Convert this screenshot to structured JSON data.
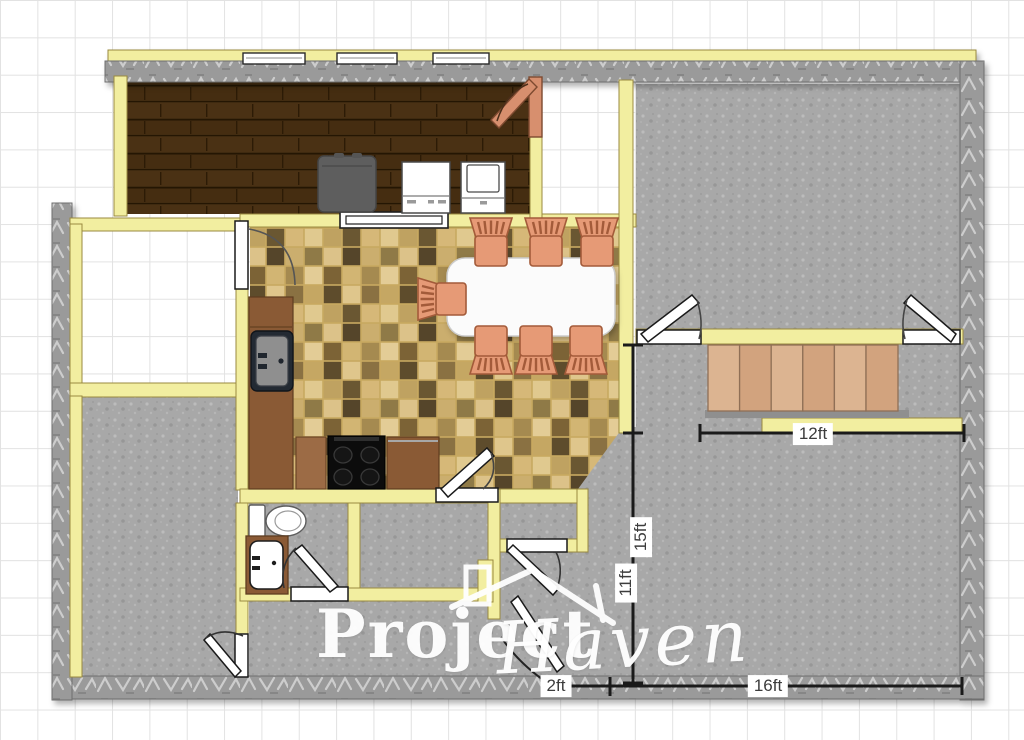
{
  "plan": {
    "dimension_labels": {
      "stairs_width": "12ft",
      "lower_height": "11ft",
      "total_height": "15ft",
      "entry_offset": "2ft",
      "bottom_width": "16ft"
    },
    "watermark": {
      "word1": "Project",
      "word2": "Haven"
    },
    "palette": {
      "wall_yellow": "#f2eea0",
      "wall_yellow_edge": "#99893f",
      "stone_gray": "#9c9c9c",
      "floor_gray": "#a8a8a8",
      "deck_brown": "#3f2a10",
      "tile_tan": "#d9bd80",
      "stair_tan": "#d8ad8b",
      "chair_salmon": "#e69a76",
      "counter_brown": "#8a5a35",
      "grid_line": "#e2e2e2",
      "dimension_line": "#1a1a1a"
    },
    "furniture": [
      "grill",
      "dishwasher",
      "washer",
      "pass-through-window",
      "kitchen-sink",
      "range-stove",
      "kitchen-counter",
      "dining-table",
      "dining-chair",
      "toilet",
      "bathroom-vanity",
      "stairs",
      "door",
      "window"
    ]
  }
}
